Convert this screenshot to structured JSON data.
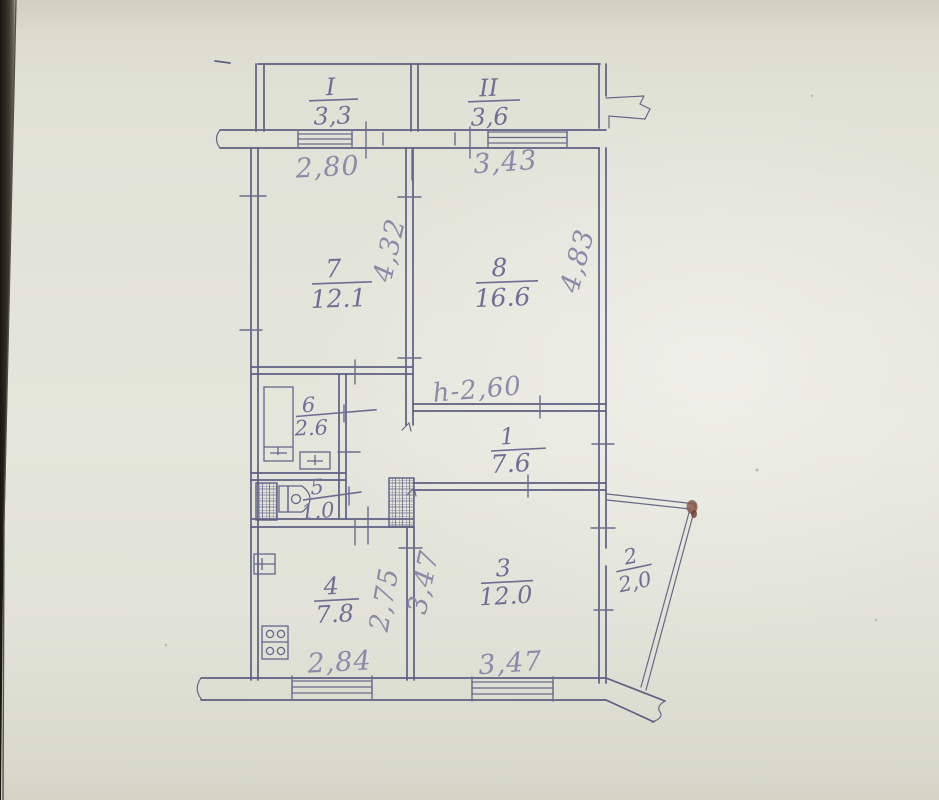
{
  "photo": {
    "description": "hand-drawn apartment floor plan on paper",
    "paper_color": "#e3e4d9",
    "ink_color": "#5d5f83",
    "pencil_color": "#8d89a8",
    "smudge_color": "#8a574b"
  },
  "plan": {
    "balconies": [
      {
        "label": "I",
        "area": "3,3"
      },
      {
        "label": "II",
        "area": "3,6"
      }
    ],
    "rooms": [
      {
        "number": "7",
        "area": "12.1"
      },
      {
        "number": "8",
        "area": "16.6"
      },
      {
        "number": "6",
        "area": "2.6"
      },
      {
        "number": "5",
        "area": "1.0"
      },
      {
        "number": "1",
        "area": "7.6"
      },
      {
        "number": "4",
        "area": "7.8"
      },
      {
        "number": "3",
        "area": "12.0"
      },
      {
        "number": "2",
        "area": "2,0"
      }
    ],
    "dimensions": {
      "top_left": "2,80",
      "top_right": "3,43",
      "room7_height": "4,32",
      "room8_height": "4,83",
      "ceiling_height": "h-2,60",
      "kitchen_height": "2,75",
      "room3_height": "3,47",
      "bottom_left": "2,84",
      "bottom_right": "3,47"
    }
  }
}
